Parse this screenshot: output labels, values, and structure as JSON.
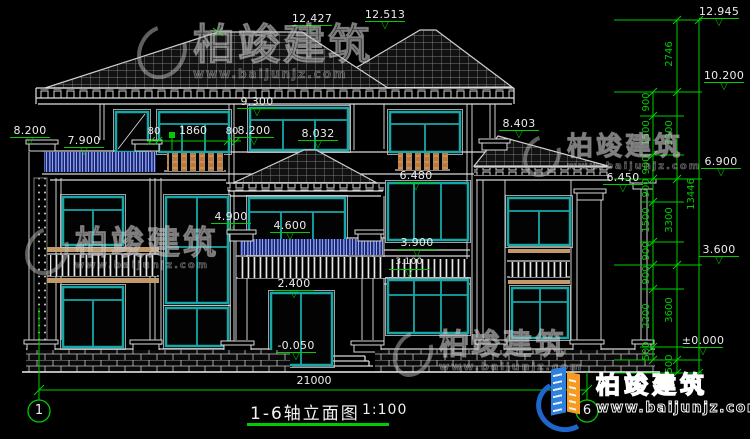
{
  "drawing": {
    "title": "1-6轴立面图",
    "scale": "1:100"
  },
  "axes": {
    "left_bubble": "1",
    "right_bubble": "6"
  },
  "elevation_marks": [
    {
      "name": "ridge-left",
      "label": "12.427"
    },
    {
      "name": "ridge-right",
      "label": "12.513"
    },
    {
      "name": "roof-top-datum",
      "label": "12.945"
    },
    {
      "name": "main-eave",
      "label": "10.200"
    },
    {
      "name": "upper-eave",
      "label": "9.300"
    },
    {
      "name": "left-parapet",
      "label": "8.200"
    },
    {
      "name": "left-balcony-rail",
      "label": "7.900"
    },
    {
      "name": "center-window-head",
      "label": "8.200"
    },
    {
      "name": "center-window-head-2",
      "label": "8.032"
    },
    {
      "name": "wing-roof-top",
      "label": "8.403"
    },
    {
      "name": "second-floor-window-head",
      "label": "6.480"
    },
    {
      "name": "wing-eave",
      "label": "6.450"
    },
    {
      "name": "second-floor-level",
      "label": "6.900"
    },
    {
      "name": "stair-window-sill",
      "label": "4.900"
    },
    {
      "name": "porch-window-head",
      "label": "4.600"
    },
    {
      "name": "balcony-rail-level",
      "label": "3.900"
    },
    {
      "name": "railing-sill-level",
      "label": "3.100"
    },
    {
      "name": "ground-window-head",
      "label": "3.600"
    },
    {
      "name": "door-head",
      "label": "2.400"
    },
    {
      "name": "entrance-slab",
      "label": "-0.050"
    },
    {
      "name": "ground-floor-datum",
      "label": "±0.000"
    }
  ],
  "dimensions": {
    "window_head": [
      "80",
      "1860",
      "80"
    ],
    "chain_inner": [
      "900",
      "1500",
      "900",
      "900",
      "1500",
      "900",
      "900",
      "2200",
      "500"
    ],
    "chain_outer": [
      "2746",
      "3300",
      "3300",
      "3600",
      "500"
    ],
    "overall_height": "13446",
    "overall_width": "21000"
  },
  "watermark": {
    "brand": "柏竣建筑",
    "url": "www.baijunjz.com"
  },
  "logo": {
    "brand": "柏竣建筑",
    "url": "www.baijunjz.com"
  },
  "colors": {
    "dimension_green": "#00cc00",
    "window_teal": "#16a8a8",
    "railing_blue": "#1b2a78",
    "balustrade_wood": "#c07838",
    "line_white": "#d8d8d8"
  }
}
